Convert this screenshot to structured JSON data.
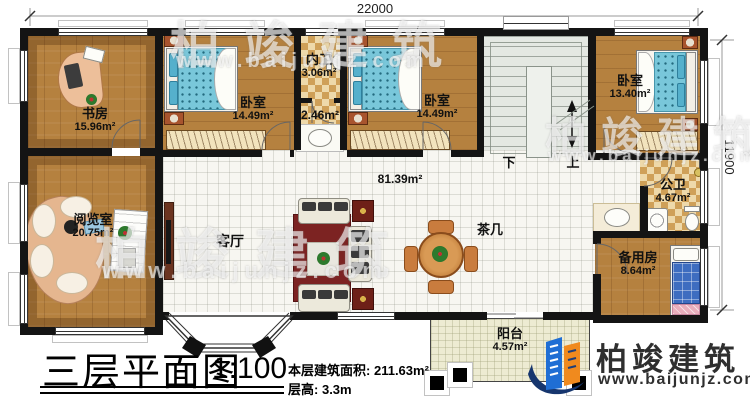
{
  "dimensions": {
    "width": "22000",
    "depth": "11900"
  },
  "rooms": {
    "study": {
      "name": "书房",
      "area": "15.96m²"
    },
    "bedroom1": {
      "name": "卧室",
      "area": "14.49m²"
    },
    "inner_bath": {
      "name": "内卫",
      "area": "3.06m²"
    },
    "wash_corridor": {
      "area": "2.46m²"
    },
    "bedroom2": {
      "name": "卧室",
      "area": "14.49m²"
    },
    "bedroom3": {
      "name": "卧室",
      "area": "13.40m²"
    },
    "public_bath": {
      "name": "公卫",
      "area": "4.67m²"
    },
    "reading_room": {
      "name": "阅览室",
      "area": "20.75m²"
    },
    "living_room": {
      "name": "客厅",
      "area": "81.39m²"
    },
    "tea_table": {
      "name": "茶几"
    },
    "spare_room": {
      "name": "备用房",
      "area": "8.64m²"
    },
    "balcony": {
      "name": "阳台",
      "area": "4.57m²"
    }
  },
  "stairs": {
    "down_label": "下",
    "up_label": "上"
  },
  "title_block": {
    "title": "三层平面图",
    "scale": "1:100",
    "area_label": "本层建筑面积:",
    "area_value": "211.63m²",
    "height_label": "层高:",
    "height_value": "3.3m"
  },
  "brand": {
    "name": "柏竣建筑",
    "website": "www.baijunjz.com"
  },
  "watermark": {
    "name": "柏竣建筑",
    "website": "www.baijunjz.com"
  },
  "colors": {
    "wall": "#141414",
    "wood": "#b5813f",
    "tile": "#cfa058",
    "bed_blue": "#79c7da",
    "brand_blue": "#1f6ed4",
    "brand_orange": "#f08a1e",
    "brand_navy": "#16366e"
  }
}
